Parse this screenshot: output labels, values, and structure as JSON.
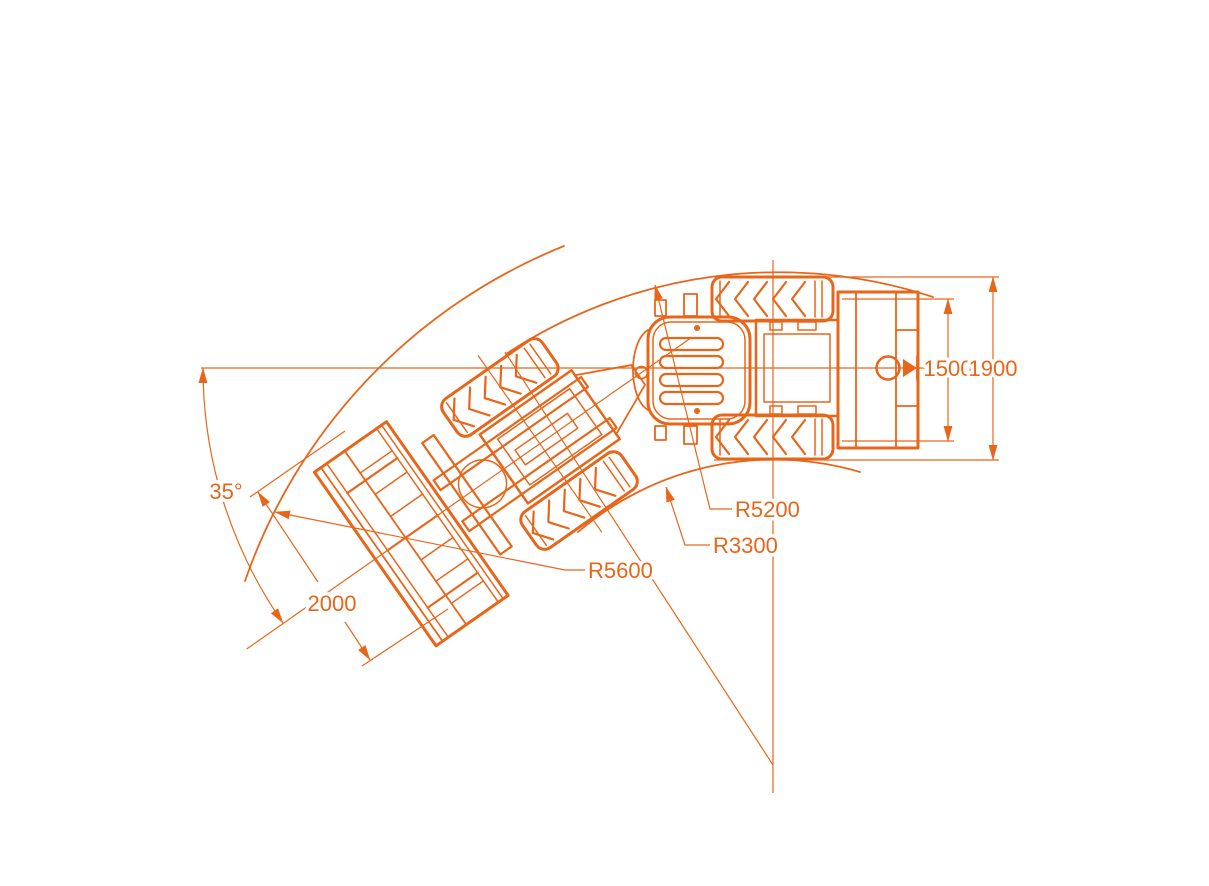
{
  "diagram": {
    "accent_color": "#E8661A",
    "background_color": "#FFFFFF",
    "labels": {
      "articulation_angle": "35°",
      "bucket_width": "2000",
      "turning_radius_bucket_outer": "R5600",
      "turning_radius_inner": "R3300",
      "turning_radius_body_outer": "R5200",
      "wheel_track": "1500",
      "overall_width": "1900"
    }
  }
}
